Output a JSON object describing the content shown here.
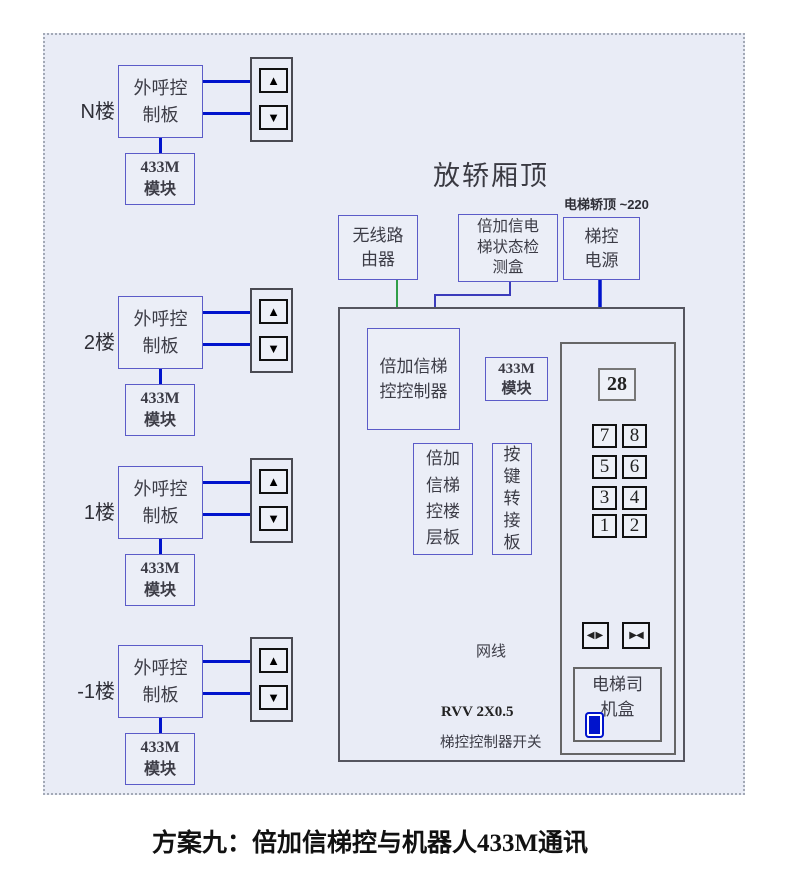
{
  "scene": {
    "title": "放轿厢顶",
    "power_note": "电梯轿顶 ~220",
    "caption": "方案九：倍加信梯控与机器人433M通讯"
  },
  "floors": [
    {
      "label": "N楼",
      "board": "外呼控\n制板",
      "module": "433M\n模块"
    },
    {
      "label": "2楼",
      "board": "外呼控\n制板",
      "module": "433M\n模块"
    },
    {
      "label": "1楼",
      "board": "外呼控\n制板",
      "module": "433M\n模块"
    },
    {
      "label": "-1楼",
      "board": "外呼控\n制板",
      "module": "433M\n模块"
    }
  ],
  "icons": {
    "up": "▲",
    "down": "▼",
    "door_open": "◀▶",
    "door_close": "▶◀"
  },
  "top_boxes": {
    "router": "无线路\n由器",
    "detector": "倍加信电\n梯状态检\n测盒",
    "power": "梯控\n电源"
  },
  "car_top": {
    "controller": "倍加信梯\n控控制器",
    "module": "433M\n模块",
    "floor_board": "倍加\n信梯\n控楼\n层板",
    "key_adapter": "按\n键\n转\n接\n板"
  },
  "cop": {
    "display": "28",
    "buttons": [
      "7",
      "8",
      "5",
      "6",
      "3",
      "4",
      "1",
      "2"
    ],
    "driver_box": "电梯司\n机盒"
  },
  "labels": {
    "network": "网线",
    "rvv": "RVV 2X0.5",
    "switch": "梯控控制器开关"
  },
  "colors": {
    "panel_bg": "#e9ecf6",
    "box_border": "#5b5bc8",
    "wire_blue": "#0013cc",
    "wire_purple": "#3b3bbb",
    "wire_green": "#2f9e48",
    "gray_border": "#55555f"
  }
}
